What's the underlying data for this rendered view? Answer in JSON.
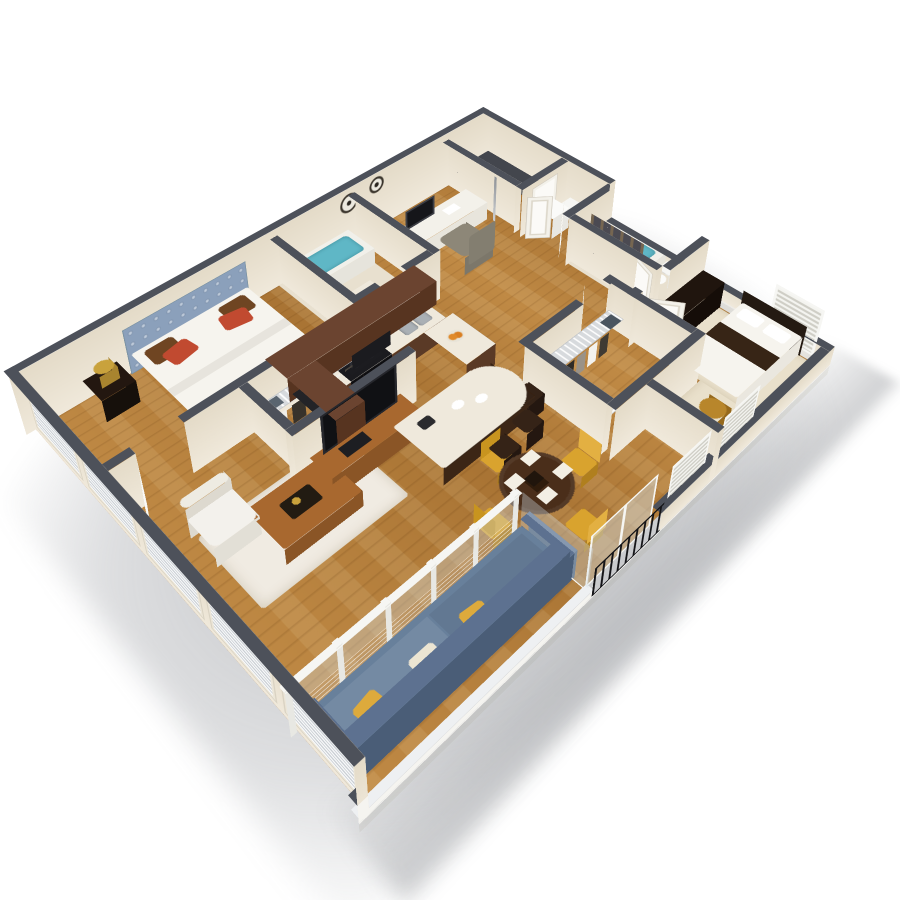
{
  "scene": {
    "kind": "3d-isometric-floor-plan-render",
    "background": "#ffffff",
    "view": "dollhouse-cutaway-from-above"
  },
  "palette": {
    "wallCap": "#4d515a",
    "wallFace": "#ece4d4",
    "wallFaceDark": "#e2d9c6",
    "wallOuter": "#f5f4f0",
    "floorWoodA": "#c08a45",
    "floorWoodB": "#a97434",
    "carpet": "#e9e0cb",
    "tile": "#e8e0cf",
    "rug": "#f0ebe2",
    "glass": "rgba(208,223,233,0.35)",
    "frameWhite": "#f6f6f3",
    "blindLight": "#f8f9fa",
    "blindDark": "#c9ced3",
    "cabinetWood": "#6b4430",
    "cabinetWoodDark": "#4e2e1c",
    "counter": "#efe9dc",
    "applianceBlack": "#1b1b1f",
    "steel": "#aab0b5",
    "islandBase": "#4e3322",
    "stool": "#352317",
    "sofa": "#68809b",
    "sofaDark": "#4f637c",
    "pillowYellow": "#ddaa3c",
    "chairWhite": "#f3f1ec",
    "woodTable": "#a8682f",
    "diningTable": "#4a2e1a",
    "chairYellow": "#d9a32e",
    "bedWhite": "#f6f4ee",
    "headboard": "#8ba0bb",
    "pillowRed": "#c14a30",
    "pillowBrown": "#6f4522",
    "nightstand": "#231710",
    "lampGold": "#c9a23c",
    "tubWater": "#5fb7c6",
    "curtainBrown": "#6f5132",
    "curtainDark": "#4b4a52",
    "dresser": "#20150e",
    "accentGold": "#b8862b",
    "shelfWire": "#d7dadd",
    "charcoal": "#43464d",
    "railBlack": "#141417",
    "doorWhite": "#fbfaf7"
  },
  "rooms": [
    {
      "name": "living-room",
      "furnishings": [
        "tv-console",
        "television",
        "white-armchair",
        "coffee-table",
        "white-area-rug",
        "window-wall-with-blinds"
      ]
    },
    {
      "name": "sun-room",
      "furnishings": [
        "blue-sofa",
        "yellow-throw-pillows",
        "glass-partition-with-cables",
        "side-table",
        "juliet-balcony-black-railing",
        "sliding-glass-door"
      ]
    },
    {
      "name": "dining-area",
      "furnishings": [
        "round-dark-wood-table",
        "four-yellow-chairs",
        "place-settings"
      ]
    },
    {
      "name": "kitchen",
      "furnishings": [
        "l-shaped-upper-cabinets",
        "black-refrigerator",
        "black-range-with-hood",
        "double-sink",
        "curved-quartz-island",
        "three-bar-stools",
        "fruit-bowl"
      ]
    },
    {
      "name": "master-bedroom",
      "furnishings": [
        "tufted-blue-headboard-bed",
        "red-and-brown-pillows",
        "nightstand",
        "gold-lamp",
        "two-wall-clocks",
        "walk-in-closet-wire-shelving"
      ]
    },
    {
      "name": "bathroom-1",
      "furnishings": [
        "bathtub",
        "brown-shower-curtain",
        "vanity-sink"
      ]
    },
    {
      "name": "office-nook",
      "furnishings": [
        "white-desk",
        "monitor",
        "gray-office-chair",
        "red-planter"
      ]
    },
    {
      "name": "corner-closet",
      "furnishings": [
        "charcoal-l-counter",
        "white-door",
        "bifold-doors",
        "linen-stacks"
      ]
    },
    {
      "name": "bathroom-2",
      "furnishings": [
        "bathtub",
        "dark-shower-curtain",
        "toilet"
      ]
    },
    {
      "name": "walk-in-closet",
      "furnishings": [
        "wire-shelves",
        "hanging-clothes",
        "storage-bins"
      ]
    },
    {
      "name": "bedroom-2",
      "furnishings": [
        "bed-with-brown-runner",
        "espresso-dresser",
        "gold-accent-table",
        "white-shutter-windows",
        "beige-carpet"
      ]
    }
  ]
}
